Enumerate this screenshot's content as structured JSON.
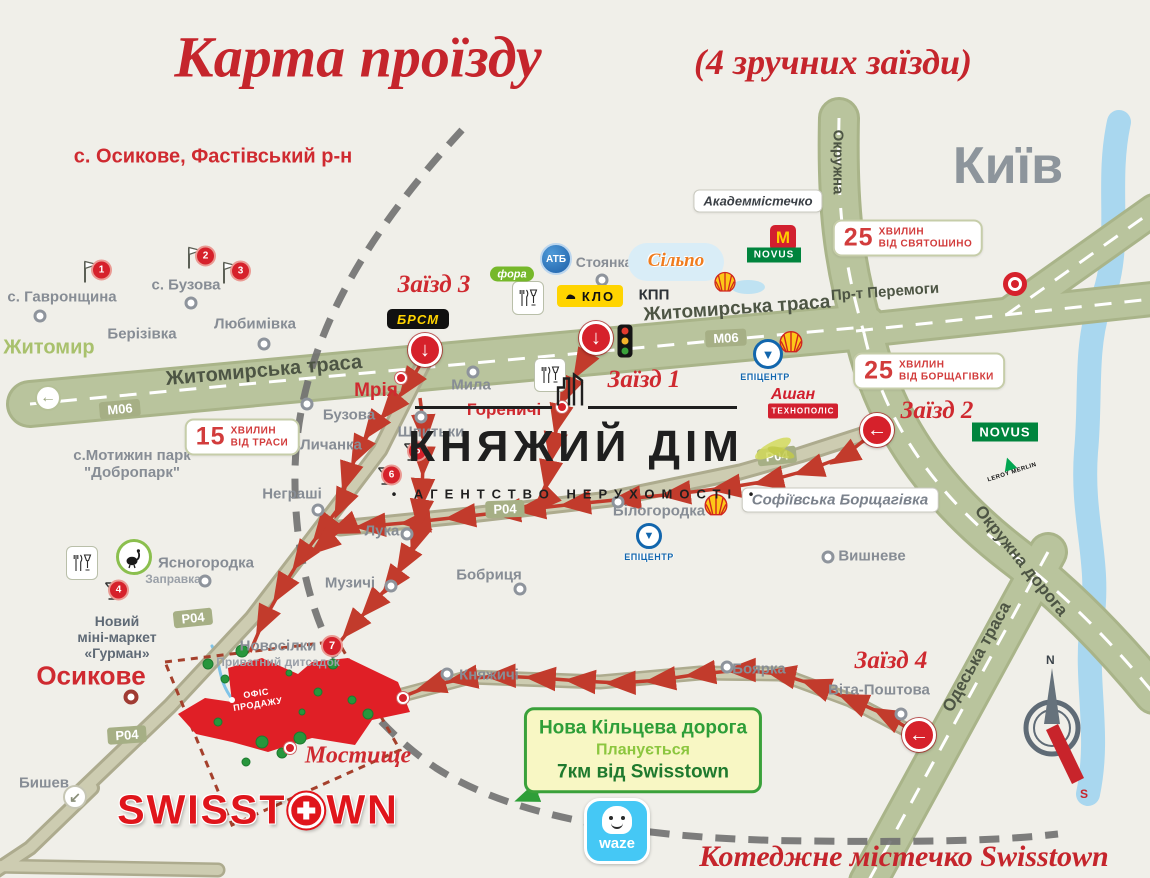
{
  "title": {
    "main": "Карта проїзду",
    "suffix": "(4 зручних заїзди)"
  },
  "subtitle": "с. Осикове, Фастівський р-н",
  "kyiv": "Київ",
  "direction_zhytomyr": "Житомир",
  "watermark": {
    "name": "КНЯЖИЙ ДІМ",
    "tagline": "• АГЕНТСТВО НЕРУХОМОСТІ •"
  },
  "roads": {
    "zhytomyrska": "Житомирська траса",
    "peremohy": "Пр-т Перемоги",
    "okruzhna": "Окружна",
    "okruzhna_doroha": "Окружна дорога",
    "odeska": "Одеська траса",
    "m06": "М06",
    "p04": "Р04"
  },
  "entrances": {
    "e1": "Заїзд 1",
    "e2": "Заїзд 2",
    "e3": "Заїзд 3",
    "e4": "Заїзд 4"
  },
  "badges": {
    "b15": {
      "num": "15",
      "line1": "хвилин",
      "line2": "від траси"
    },
    "b25a": {
      "num": "25",
      "line1": "хвилин",
      "line2": "від святошино"
    },
    "b25b": {
      "num": "25",
      "line1": "хвилин",
      "line2": "від борщагівки"
    }
  },
  "places": {
    "havronshchyna": "с. Гавронщина",
    "buzova_s": "с. Бузова",
    "liubymivka": "Любимівка",
    "berizivka": "Берізівка",
    "myla": "Мила",
    "buzova": "Бузова",
    "lychanka": "Личанка",
    "shpytky": "Шпитьки",
    "nehrashi": "Неграші",
    "luka": "Лука",
    "muzychi": "Музичі",
    "bobrytsia": "Бобриця",
    "yasnohorodka": "Ясногородка",
    "zapravka": "Заправка",
    "novosilky": "Новосілки",
    "dytsadok": "Приватний дитсадок",
    "kniazhychi": "Княжичі",
    "boiarka": "Боярка",
    "vita": "Віта-Поштова",
    "vyshneve": "Вишневе",
    "bilohorodka": "Білогородка",
    "stoianka": "Стоянка",
    "kpp": "КПП",
    "byshev": "Бишев",
    "motyzhyn1": "с.Мотижин парк",
    "motyzhyn2": "\"Добропарк\"",
    "mriya": "Мрія",
    "horenychi": "Гореничі",
    "osykove": "Осикове",
    "mostyshche": "Мостище",
    "akadem": "Академмістечко",
    "sofiivska": "Софіївська Борщагівка",
    "gurman1": "Новий",
    "gurman2": "міні-маркет",
    "gurman3": "«Гурман»"
  },
  "brands": {
    "brsm": "БРСМ",
    "fora": "фора",
    "atb": "АТБ",
    "silpo": "Сільпо",
    "klo": "КЛО",
    "mcdonalds": "M",
    "novus": "NOVUS",
    "epicentr": "ЕПІЦЕНТР",
    "ashan": "Ашан",
    "technopolis": "ТЕХНОПОЛІС",
    "leroy": "LEROY MERLIN",
    "waze": "waze"
  },
  "sales_office": {
    "line1": "ОФІС",
    "line2": "ПРОДАЖУ"
  },
  "ring_road": {
    "line1": "Нова Кільцева дорога",
    "line2": "Планується",
    "line3": "7км від Swisstown"
  },
  "swisstown": {
    "part1": "SWISST",
    "part2": "WN"
  },
  "footer": "Котеджне містечко Swisstown",
  "compass": {
    "n": "N",
    "s": "S"
  },
  "markers": {
    "m1": "1",
    "m2": "2",
    "m3": "3",
    "m4": "4",
    "m5": "5",
    "m6": "6",
    "m7": "7"
  },
  "icons": {
    "down": "↓",
    "left": "←",
    "southwest": "↙",
    "west": "←",
    "epi_arrow": "▼",
    "leroy_tri": "▲"
  }
}
